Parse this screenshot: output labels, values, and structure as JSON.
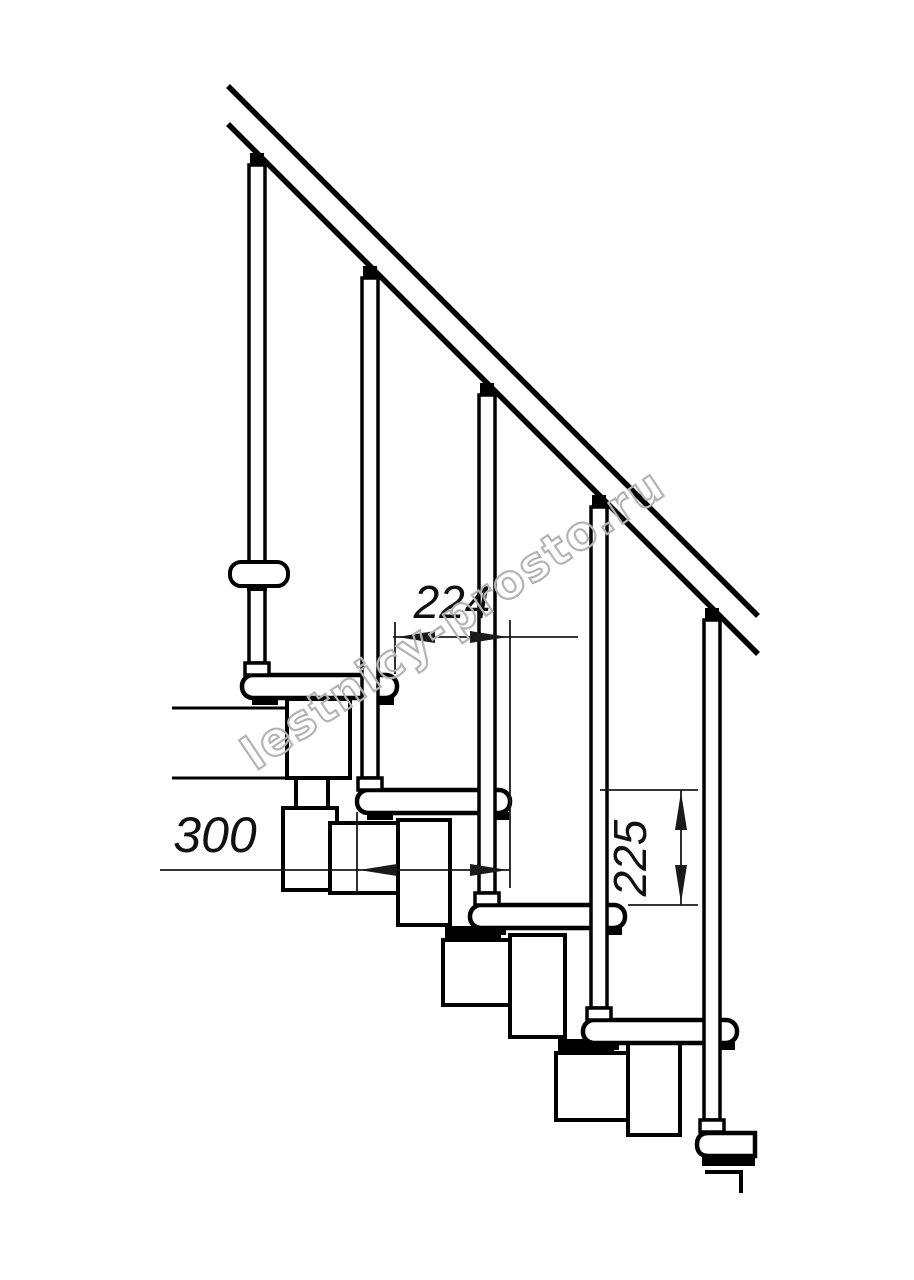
{
  "dimensions": {
    "step_offset": {
      "value": "224",
      "orientation": "horizontal"
    },
    "tread_depth": {
      "value": "300",
      "orientation": "horizontal"
    },
    "riser_height": {
      "value": "225",
      "orientation": "vertical"
    }
  },
  "watermark": {
    "text": "lestnicy-prosto.ru",
    "color": "#b4b4b4"
  },
  "colors": {
    "line": "#000000",
    "dimension_line": "#1a1a1a",
    "background": "#ffffff"
  }
}
